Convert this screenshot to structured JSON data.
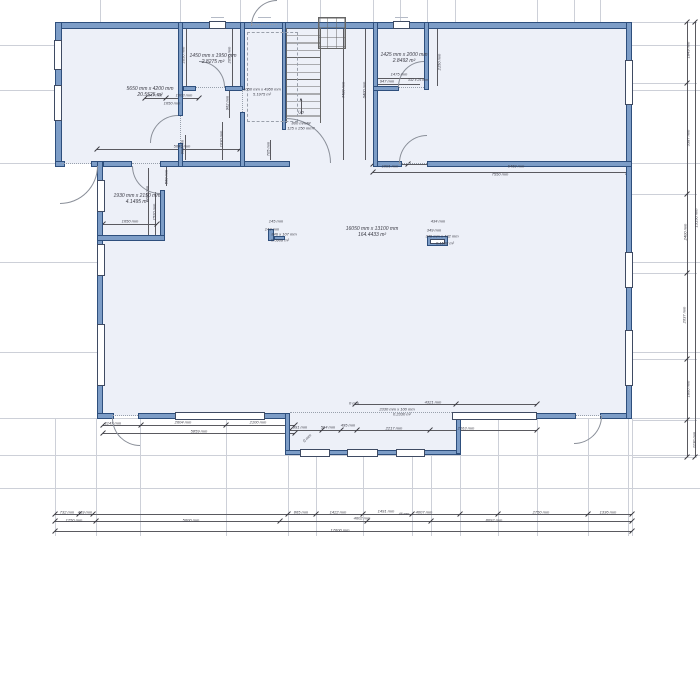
{
  "drawing_type": "floor-plan",
  "colors": {
    "wall_fill": "#7d9dc7",
    "wall_edge": "#2e4f7d",
    "room_fill": "#edf0f8",
    "dim_text": "#3c3c46",
    "extension_line": "#cdd0d8"
  },
  "stairs": {
    "direction_label": "Up",
    "arrow_glyph": "▲",
    "spec_line1": "800 mm/M",
    "spec_line2": "125 x 250 mm?"
  },
  "rooms": [
    {
      "name": "closet-top-left",
      "size": "1450 mm x 1950 mm",
      "area": "2.8275 m²"
    },
    {
      "name": "bedroom-top-left",
      "size": "5650 mm x 4200 mm",
      "area": "20.5525 m²"
    },
    {
      "name": "stair-hall",
      "size": "1050 mm x 4950 mm",
      "area": "5.1975 m²"
    },
    {
      "name": "closet-top-right",
      "size": "1425 mm x 2000 mm",
      "area": "2.8492 m²"
    },
    {
      "name": "left-small-room",
      "size": "1930 mm x 2150 mm",
      "area": "4.1495 m²"
    },
    {
      "name": "great-room",
      "size": "16050 mm x 13100 mm",
      "area": "164.4433 m²"
    }
  ],
  "annotations": {
    "labels": [
      {
        "t": "1450 mm x 1950 mm",
        "x": 213,
        "y": 56,
        "s": 5
      },
      {
        "t": "2.8275 m²",
        "x": 213,
        "y": 62,
        "s": 5
      },
      {
        "t": "5650 mm x 4200 mm",
        "x": 150,
        "y": 89,
        "s": 5
      },
      {
        "t": "20.5525 m²",
        "x": 150,
        "y": 95,
        "s": 5
      },
      {
        "t": "1050 mm x 4950 mm",
        "x": 262,
        "y": 89,
        "s": 4
      },
      {
        "t": "5.1975 m²",
        "x": 262,
        "y": 94,
        "s": 4
      },
      {
        "t": "1425 mm x 2000 mm",
        "x": 404,
        "y": 55,
        "s": 5
      },
      {
        "t": "2.8492 m²",
        "x": 404,
        "y": 61,
        "s": 5
      },
      {
        "t": "1930 mm x 2150 mm",
        "x": 137,
        "y": 196,
        "s": 5
      },
      {
        "t": "4.1495 m²",
        "x": 137,
        "y": 202,
        "s": 5
      },
      {
        "t": "16050 mm x 13100 mm",
        "x": 372,
        "y": 229,
        "s": 5
      },
      {
        "t": "164.4433 m²",
        "x": 372,
        "y": 235,
        "s": 5
      },
      {
        "t": "Up",
        "x": 301,
        "y": 112,
        "s": 4.5
      },
      {
        "t": "▲",
        "x": 301,
        "y": 99,
        "s": 4.5
      },
      {
        "t": "800 mm/M",
        "x": 301,
        "y": 123,
        "s": 4
      },
      {
        "t": "125 x 250 mm?",
        "x": 301,
        "y": 128,
        "s": 4
      },
      {
        "t": "145 mm",
        "x": 276,
        "y": 221,
        "s": 4
      },
      {
        "t": "143 mm",
        "x": 272,
        "y": 229,
        "s": 4
      },
      {
        "t": "846 x 107 mm",
        "x": 284,
        "y": 234,
        "s": 4
      },
      {
        "t": "0.0908 m²",
        "x": 280,
        "y": 240,
        "s": 4
      },
      {
        "t": "434 mm",
        "x": 438,
        "y": 221,
        "s": 4
      },
      {
        "t": "349 mm",
        "x": 434,
        "y": 230,
        "s": 4
      },
      {
        "t": "349 mm x 432 mm",
        "x": 442,
        "y": 236,
        "s": 4
      },
      {
        "t": "0.1508 m²",
        "x": 445,
        "y": 243,
        "s": 4
      },
      {
        "t": "647 mm",
        "x": 155,
        "y": 95,
        "s": 4
      },
      {
        "t": "1003 mm",
        "x": 184,
        "y": 95,
        "s": 4
      },
      {
        "t": "1650 mm",
        "x": 172,
        "y": 103,
        "s": 4
      },
      {
        "t": "5649 mm",
        "x": 182,
        "y": 146,
        "s": 4
      },
      {
        "t": "2050 mm",
        "x": 183,
        "y": 55,
        "r": -90,
        "s": 4
      },
      {
        "t": "2050 mm",
        "x": 229,
        "y": 55,
        "r": -90,
        "s": 4
      },
      {
        "t": "962 mm",
        "x": 227,
        "y": 103,
        "r": -90,
        "s": 4
      },
      {
        "t": "1030 mm",
        "x": 221,
        "y": 139,
        "r": -90,
        "s": 4
      },
      {
        "t": "900 mm",
        "x": 182,
        "y": 147,
        "r": -90,
        "s": 4
      },
      {
        "t": "705 mm",
        "x": 268,
        "y": 149,
        "r": -90,
        "s": 4
      },
      {
        "t": "4400 mm",
        "x": 343,
        "y": 90,
        "r": -90,
        "s": 4
      },
      {
        "t": "6400 mm",
        "x": 364,
        "y": 90,
        "r": -90,
        "s": 4
      },
      {
        "t": "1475 mm",
        "x": 399,
        "y": 74,
        "s": 4
      },
      {
        "t": "947 mm",
        "x": 387,
        "y": 81,
        "s": 4
      },
      {
        "t": "332 x 25 mm",
        "x": 418,
        "y": 80,
        "s": 3.5
      },
      {
        "t": "2150 mm",
        "x": 439,
        "y": 62,
        "r": -90,
        "s": 4
      },
      {
        "t": "1081 mm",
        "x": 390,
        "y": 166,
        "s": 4
      },
      {
        "t": "6469 mm",
        "x": 516,
        "y": 166,
        "s": 4
      },
      {
        "t": "7550 mm",
        "x": 500,
        "y": 174,
        "s": 4
      },
      {
        "t": "1650 mm",
        "x": 130,
        "y": 221,
        "s": 4
      },
      {
        "t": "1520 mm",
        "x": 154,
        "y": 212,
        "r": -90,
        "s": 4
      },
      {
        "t": "1100 mm",
        "x": 147,
        "y": 194,
        "r": -90,
        "s": 4
      },
      {
        "t": "560 mm",
        "x": 166,
        "y": 177,
        "r": -90,
        "s": 4
      },
      {
        "t": "1147 mm",
        "x": 113,
        "y": 423,
        "s": 4
      },
      {
        "t": "2604 mm",
        "x": 183,
        "y": 422,
        "s": 4
      },
      {
        "t": "2100 mm",
        "x": 258,
        "y": 422,
        "s": 4
      },
      {
        "t": "5859 mm",
        "x": 199,
        "y": 431,
        "s": 4
      },
      {
        "t": "991 mm",
        "x": 300,
        "y": 427,
        "s": 4
      },
      {
        "t": "564 mm",
        "x": 328,
        "y": 427,
        "s": 4
      },
      {
        "t": "495 mm",
        "x": 348,
        "y": 425,
        "s": 4
      },
      {
        "t": "2217 mm",
        "x": 394,
        "y": 428,
        "s": 4
      },
      {
        "t": "2163 mm",
        "x": 466,
        "y": 428,
        "s": 4
      },
      {
        "t": "0 mm",
        "x": 307,
        "y": 438,
        "r": -45,
        "s": 4
      },
      {
        "t": "0 mm",
        "x": 354,
        "y": 403,
        "s": 4
      },
      {
        "t": "2330 mm x 100 mm",
        "x": 397,
        "y": 409,
        "s": 4
      },
      {
        "t": "0.2330 m²",
        "x": 402,
        "y": 414,
        "s": 4
      },
      {
        "t": "4321 mm",
        "x": 433,
        "y": 402,
        "s": 4
      },
      {
        "t": "732 mm",
        "x": 67,
        "y": 512,
        "s": 4
      },
      {
        "t": "419 mm",
        "x": 85,
        "y": 512,
        "s": 4
      },
      {
        "t": "865 mm",
        "x": 301,
        "y": 512,
        "s": 4
      },
      {
        "t": "1422 mm",
        "x": 338,
        "y": 512,
        "s": 4
      },
      {
        "t": "1491 mm",
        "x": 386,
        "y": 511,
        "s": 4
      },
      {
        "t": "46 mm",
        "x": 404,
        "y": 514,
        "s": 3.5
      },
      {
        "t": "4007 mm",
        "x": 424,
        "y": 512,
        "s": 4
      },
      {
        "t": "2750 mm",
        "x": 541,
        "y": 512,
        "s": 4
      },
      {
        "t": "1336 mm",
        "x": 608,
        "y": 512,
        "s": 4
      },
      {
        "t": "1250 mm",
        "x": 74,
        "y": 520,
        "s": 4
      },
      {
        "t": "5600 mm",
        "x": 191,
        "y": 520,
        "s": 4
      },
      {
        "t": "4602 mm",
        "x": 362,
        "y": 518,
        "s": 4
      },
      {
        "t": "8092 mm",
        "x": 494,
        "y": 520,
        "s": 4
      },
      {
        "t": "17600 mm",
        "x": 340,
        "y": 530,
        "s": 4
      },
      {
        "t": "1849 mm",
        "x": 688,
        "y": 50,
        "r": -90,
        "s": 4
      },
      {
        "t": "3387 mm",
        "x": 688,
        "y": 138,
        "r": -90,
        "s": 4
      },
      {
        "t": "2400 mm",
        "x": 685,
        "y": 232,
        "r": -90,
        "s": 4
      },
      {
        "t": "2637 mm",
        "x": 684,
        "y": 315,
        "r": -90,
        "s": 4
      },
      {
        "t": "1860 mm",
        "x": 688,
        "y": 389,
        "r": -90,
        "s": 4
      },
      {
        "t": "1130 mm",
        "x": 694,
        "y": 440,
        "r": -90,
        "s": 4
      },
      {
        "t": "13150 mm",
        "x": 696,
        "y": 218,
        "r": -90,
        "s": 4
      }
    ],
    "gray_lines": [
      {
        "x": 0,
        "y": 45,
        "w": 700
      },
      {
        "x": 0,
        "y": 90,
        "w": 700
      },
      {
        "x": 0,
        "y": 163,
        "w": 700
      },
      {
        "x": 0,
        "y": 262,
        "w": 700
      },
      {
        "x": 0,
        "y": 352,
        "w": 700
      },
      {
        "x": 0,
        "y": 418,
        "w": 700
      },
      {
        "x": 0,
        "y": 455,
        "w": 700
      },
      {
        "x": 0,
        "y": 488,
        "w": 700
      },
      {
        "x": 100,
        "y": 0,
        "h": 22
      },
      {
        "x": 180,
        "y": 0,
        "h": 22
      },
      {
        "x": 240,
        "y": 0,
        "h": 22
      },
      {
        "x": 287,
        "y": 0,
        "h": 22
      },
      {
        "x": 320,
        "y": 0,
        "h": 22
      },
      {
        "x": 373,
        "y": 0,
        "h": 22
      },
      {
        "x": 400,
        "y": 0,
        "h": 22
      },
      {
        "x": 427,
        "y": 0,
        "h": 22
      },
      {
        "x": 455,
        "y": 0,
        "h": 22
      },
      {
        "x": 537,
        "y": 0,
        "h": 22
      },
      {
        "x": 574,
        "y": 0,
        "h": 22
      },
      {
        "x": 600,
        "y": 0,
        "h": 22
      },
      {
        "x": 55,
        "y": 418,
        "h": 118
      },
      {
        "x": 96,
        "y": 418,
        "h": 118
      },
      {
        "x": 140,
        "y": 418,
        "h": 118
      },
      {
        "x": 226,
        "y": 418,
        "h": 118
      },
      {
        "x": 288,
        "y": 418,
        "h": 118
      },
      {
        "x": 316,
        "y": 418,
        "h": 118
      },
      {
        "x": 363,
        "y": 418,
        "h": 118
      },
      {
        "x": 412,
        "y": 418,
        "h": 118
      },
      {
        "x": 431,
        "y": 418,
        "h": 118
      },
      {
        "x": 460,
        "y": 418,
        "h": 118
      },
      {
        "x": 498,
        "y": 418,
        "h": 118
      },
      {
        "x": 537,
        "y": 418,
        "h": 118
      },
      {
        "x": 588,
        "y": 418,
        "h": 118
      },
      {
        "x": 628,
        "y": 418,
        "h": 118
      },
      {
        "x": 632,
        "y": 418,
        "h": 118
      },
      {
        "x": 632,
        "y": 22,
        "w": 65
      },
      {
        "x": 632,
        "y": 83,
        "w": 65
      },
      {
        "x": 632,
        "y": 194,
        "w": 65
      },
      {
        "x": 632,
        "y": 273,
        "w": 65
      },
      {
        "x": 632,
        "y": 359,
        "w": 65
      },
      {
        "x": 632,
        "y": 420,
        "w": 65
      },
      {
        "x": 632,
        "y": 457,
        "w": 65
      }
    ],
    "tags": [
      {
        "x": 211,
        "y": 17
      },
      {
        "x": 395,
        "y": 17
      },
      {
        "x": 258,
        "y": 17
      },
      {
        "x": 214,
        "y": 408
      },
      {
        "x": 488,
        "y": 408
      },
      {
        "x": 122,
        "y": 409
      },
      {
        "x": 582,
        "y": 409
      },
      {
        "x": 309,
        "y": 445
      },
      {
        "x": 356,
        "y": 445
      },
      {
        "x": 404,
        "y": 445
      }
    ],
    "dim_lines": [
      {
        "x": 55,
        "y": 514,
        "w": 577
      },
      {
        "x": 55,
        "y": 521,
        "w": 577
      },
      {
        "x": 55,
        "y": 531,
        "w": 577
      },
      {
        "x": 687,
        "y": 22,
        "h": 435
      },
      {
        "x": 695,
        "y": 22,
        "h": 435
      },
      {
        "x": 145,
        "y": 98,
        "w": 54
      },
      {
        "x": 97,
        "y": 149,
        "w": 143
      },
      {
        "x": 378,
        "y": 78,
        "w": 48
      },
      {
        "x": 378,
        "y": 84,
        "w": 42
      },
      {
        "x": 373,
        "y": 164,
        "w": 255
      },
      {
        "x": 373,
        "y": 172,
        "w": 255
      },
      {
        "x": 103,
        "y": 224,
        "w": 54
      },
      {
        "x": 155,
        "y": 192,
        "h": 46
      },
      {
        "x": 148,
        "y": 168,
        "h": 67
      },
      {
        "x": 166,
        "y": 166,
        "h": 20
      },
      {
        "x": 103,
        "y": 425,
        "w": 192
      },
      {
        "x": 103,
        "y": 433,
        "w": 192
      },
      {
        "x": 290,
        "y": 430,
        "w": 247
      },
      {
        "x": 355,
        "y": 404,
        "w": 182
      },
      {
        "x": 186,
        "y": 28,
        "h": 58
      },
      {
        "x": 232,
        "y": 28,
        "h": 58
      },
      {
        "x": 229,
        "y": 90,
        "h": 28
      },
      {
        "x": 222,
        "y": 122,
        "h": 38
      },
      {
        "x": 185,
        "y": 135,
        "h": 25
      },
      {
        "x": 270,
        "y": 140,
        "h": 20
      },
      {
        "x": 343,
        "y": 28,
        "h": 132
      },
      {
        "x": 365,
        "y": 28,
        "h": 132
      },
      {
        "x": 437,
        "y": 28,
        "h": 58
      },
      {
        "x": 301,
        "y": 100,
        "h": 14
      }
    ],
    "ticks": [
      {
        "x": 55,
        "y": 514
      },
      {
        "x": 79,
        "y": 514
      },
      {
        "x": 93,
        "y": 514
      },
      {
        "x": 288,
        "y": 514
      },
      {
        "x": 316,
        "y": 514
      },
      {
        "x": 363,
        "y": 514
      },
      {
        "x": 412,
        "y": 514
      },
      {
        "x": 460,
        "y": 514
      },
      {
        "x": 498,
        "y": 514
      },
      {
        "x": 588,
        "y": 514
      },
      {
        "x": 632,
        "y": 514
      },
      {
        "x": 55,
        "y": 521
      },
      {
        "x": 96,
        "y": 521
      },
      {
        "x": 280,
        "y": 521
      },
      {
        "x": 367,
        "y": 521
      },
      {
        "x": 431,
        "y": 521
      },
      {
        "x": 632,
        "y": 521
      },
      {
        "x": 55,
        "y": 531
      },
      {
        "x": 632,
        "y": 531
      },
      {
        "x": 687,
        "y": 22
      },
      {
        "x": 687,
        "y": 83
      },
      {
        "x": 687,
        "y": 194
      },
      {
        "x": 687,
        "y": 273
      },
      {
        "x": 687,
        "y": 359
      },
      {
        "x": 687,
        "y": 420
      },
      {
        "x": 687,
        "y": 457
      },
      {
        "x": 695,
        "y": 22
      },
      {
        "x": 695,
        "y": 457
      },
      {
        "x": 145,
        "y": 98
      },
      {
        "x": 166,
        "y": 98
      },
      {
        "x": 199,
        "y": 98
      },
      {
        "x": 97,
        "y": 149
      },
      {
        "x": 240,
        "y": 149
      },
      {
        "x": 373,
        "y": 164
      },
      {
        "x": 408,
        "y": 164
      },
      {
        "x": 628,
        "y": 164
      },
      {
        "x": 373,
        "y": 172
      },
      {
        "x": 628,
        "y": 172
      },
      {
        "x": 103,
        "y": 224
      },
      {
        "x": 157,
        "y": 224
      },
      {
        "x": 103,
        "y": 425
      },
      {
        "x": 141,
        "y": 425
      },
      {
        "x": 226,
        "y": 425
      },
      {
        "x": 295,
        "y": 425
      },
      {
        "x": 103,
        "y": 433
      },
      {
        "x": 295,
        "y": 433
      },
      {
        "x": 290,
        "y": 430
      },
      {
        "x": 322,
        "y": 430
      },
      {
        "x": 341,
        "y": 430
      },
      {
        "x": 357,
        "y": 430
      },
      {
        "x": 430,
        "y": 430
      },
      {
        "x": 537,
        "y": 430
      },
      {
        "x": 355,
        "y": 404
      },
      {
        "x": 456,
        "y": 404
      },
      {
        "x": 537,
        "y": 404
      }
    ],
    "windows": [
      {
        "x": 209,
        "y": 20.5,
        "w": 17,
        "h": 8
      },
      {
        "x": 393,
        "y": 20.5,
        "w": 17,
        "h": 8
      },
      {
        "x": 53.5,
        "y": 40,
        "w": 8,
        "h": 30
      },
      {
        "x": 53.5,
        "y": 85,
        "w": 8,
        "h": 36
      },
      {
        "x": 96.5,
        "y": 180,
        "w": 8,
        "h": 32
      },
      {
        "x": 96.5,
        "y": 244,
        "w": 8,
        "h": 32
      },
      {
        "x": 96.5,
        "y": 324,
        "w": 8,
        "h": 62
      },
      {
        "x": 624.5,
        "y": 60,
        "w": 8,
        "h": 45
      },
      {
        "x": 624.5,
        "y": 252,
        "w": 8,
        "h": 36
      },
      {
        "x": 624.5,
        "y": 330,
        "w": 8,
        "h": 56
      },
      {
        "x": 175,
        "y": 411.5,
        "w": 90,
        "h": 8
      },
      {
        "x": 452,
        "y": 411.5,
        "w": 85,
        "h": 8
      },
      {
        "x": 300,
        "y": 448.5,
        "w": 30,
        "h": 8
      },
      {
        "x": 347,
        "y": 448.5,
        "w": 31,
        "h": 8
      },
      {
        "x": 396,
        "y": 448.5,
        "w": 29,
        "h": 8
      }
    ],
    "dashed": [
      {
        "x": 251,
        "y": 24,
        "w": 26
      },
      {
        "x": 112,
        "y": 415,
        "w": 28
      },
      {
        "x": 574,
        "y": 415,
        "w": 27
      },
      {
        "x": 132,
        "y": 163,
        "w": 28
      },
      {
        "x": 399,
        "y": 163,
        "w": 28
      },
      {
        "x": 196,
        "y": 87,
        "w": 29
      },
      {
        "x": 397,
        "y": 87,
        "w": 27
      },
      {
        "x": 290,
        "y": 412,
        "w": 166
      },
      {
        "x": 62,
        "y": 163,
        "w": 29
      },
      {
        "x": 180,
        "y": 116,
        "h": 27
      },
      {
        "x": 242,
        "y": 90,
        "h": 22
      }
    ]
  }
}
